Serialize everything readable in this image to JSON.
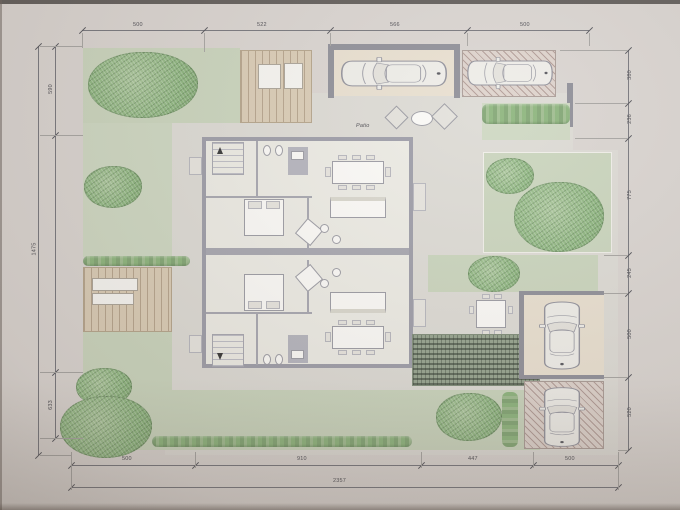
{
  "plan": {
    "patio_label": "Patio",
    "dims": {
      "top": [
        "500",
        "522",
        "566",
        "500"
      ],
      "bottom": [
        "500",
        "910",
        "447",
        "500"
      ],
      "bottom_total": "2357",
      "left": [
        "590",
        "1475",
        "633"
      ],
      "right": [
        "380",
        "236",
        "775",
        "245",
        "500",
        "520"
      ]
    },
    "colors": {
      "paper": "#d9d4d0",
      "lawn": "#c9d4bc",
      "tree": "#8ab47c",
      "deck": "#d9cbb4",
      "wall": "#8d8d96",
      "floor": "#ecebe4",
      "hatch": "#ddd2cb",
      "dimension_line": "#74747a"
    }
  }
}
